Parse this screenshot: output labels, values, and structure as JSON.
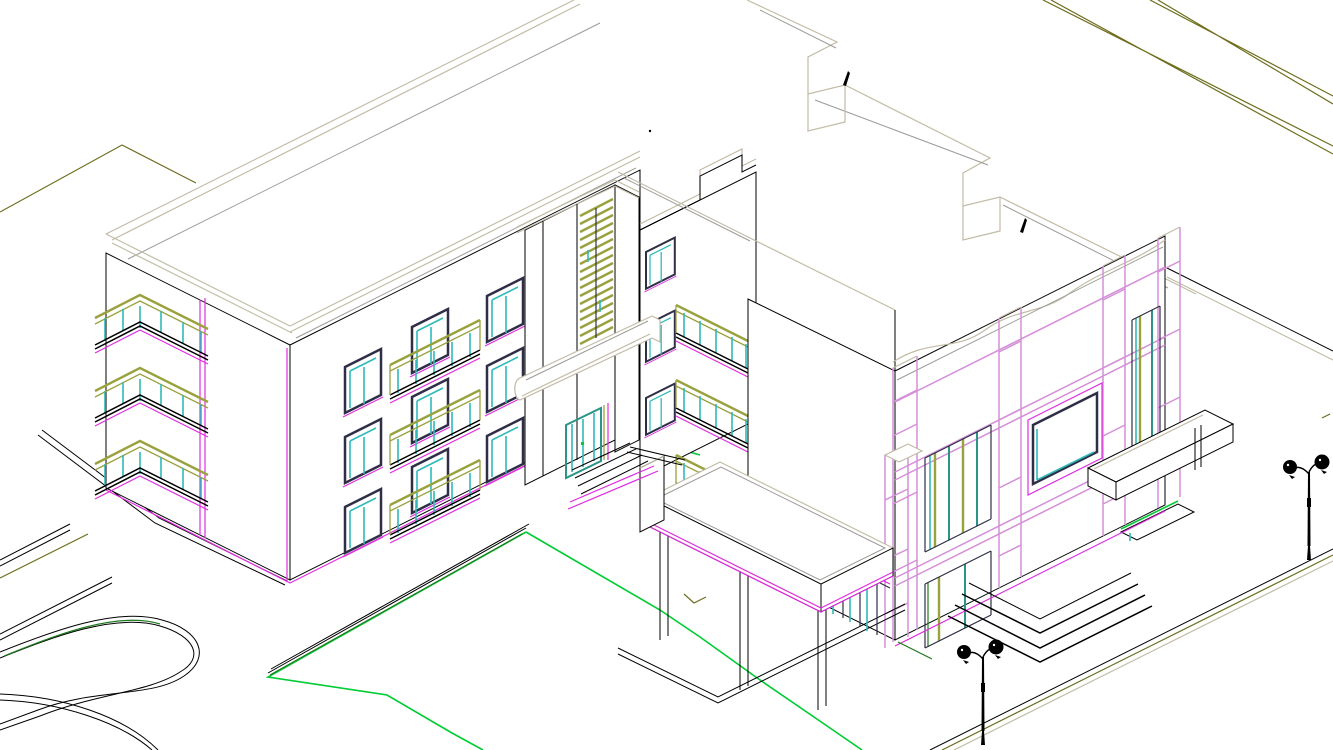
{
  "canvas": {
    "width": 1333,
    "height": 750,
    "description": "Isometric hidden-line CAD rendering of an L-shaped three-storey residential building with entrance tower, cantilevered terrace on pilotis, two-storey framed wing, site roads, lawn and twin-globe street lamps",
    "view": "SE isometric wireframe",
    "background": "#ffffff"
  },
  "colors": {
    "paper": "#ffffff",
    "ink": "#000000",
    "frame": "#2e2e46",
    "tan": "#c2bba6",
    "gray": "#9a9a96",
    "magenta": "#e02ce0",
    "violet": "#d48fd8",
    "olive": "#9aa23e",
    "road": "#6e6e1e",
    "cyan": "#2fb9b9",
    "teal": "#2b9488",
    "green": "#00cc33",
    "greendark": "#1e7a1e"
  },
  "scene": {
    "buildings": [
      {
        "name": "left-wing",
        "storeys": 3,
        "features": [
          "flat roof with parapet",
          "two window columns",
          "recessed balcony bay with olive railings and cyan glass",
          "corner balcony stack",
          "magenta wall trims"
        ]
      },
      {
        "name": "entrance-tower",
        "features": [
          "vertical olive louver stack",
          "entry canopy",
          "teal-framed glass double door",
          "entry steps"
        ]
      },
      {
        "name": "link-block",
        "features": [
          "stepped parapet",
          "window strip",
          "three stacked balconies"
        ]
      },
      {
        "name": "right-wing",
        "storeys": 2,
        "features": [
          "notched back parapet",
          "wavy front parapet",
          "violet column-and-beam frame",
          "picture window",
          "mullioned windows",
          "side balcony slab",
          "entry step chevrons"
        ]
      },
      {
        "name": "terrace",
        "features": [
          "cantilevered roof slab",
          "magenta fascia",
          "glazed wall below",
          "three pilotis columns"
        ]
      }
    ],
    "site": [
      "olive perimeter roads",
      "curved footpaths",
      "green lawn outline",
      "paved walkways"
    ],
    "lamps": {
      "count": 2,
      "style": "twin-globe post lamp",
      "color": "#000000"
    }
  }
}
